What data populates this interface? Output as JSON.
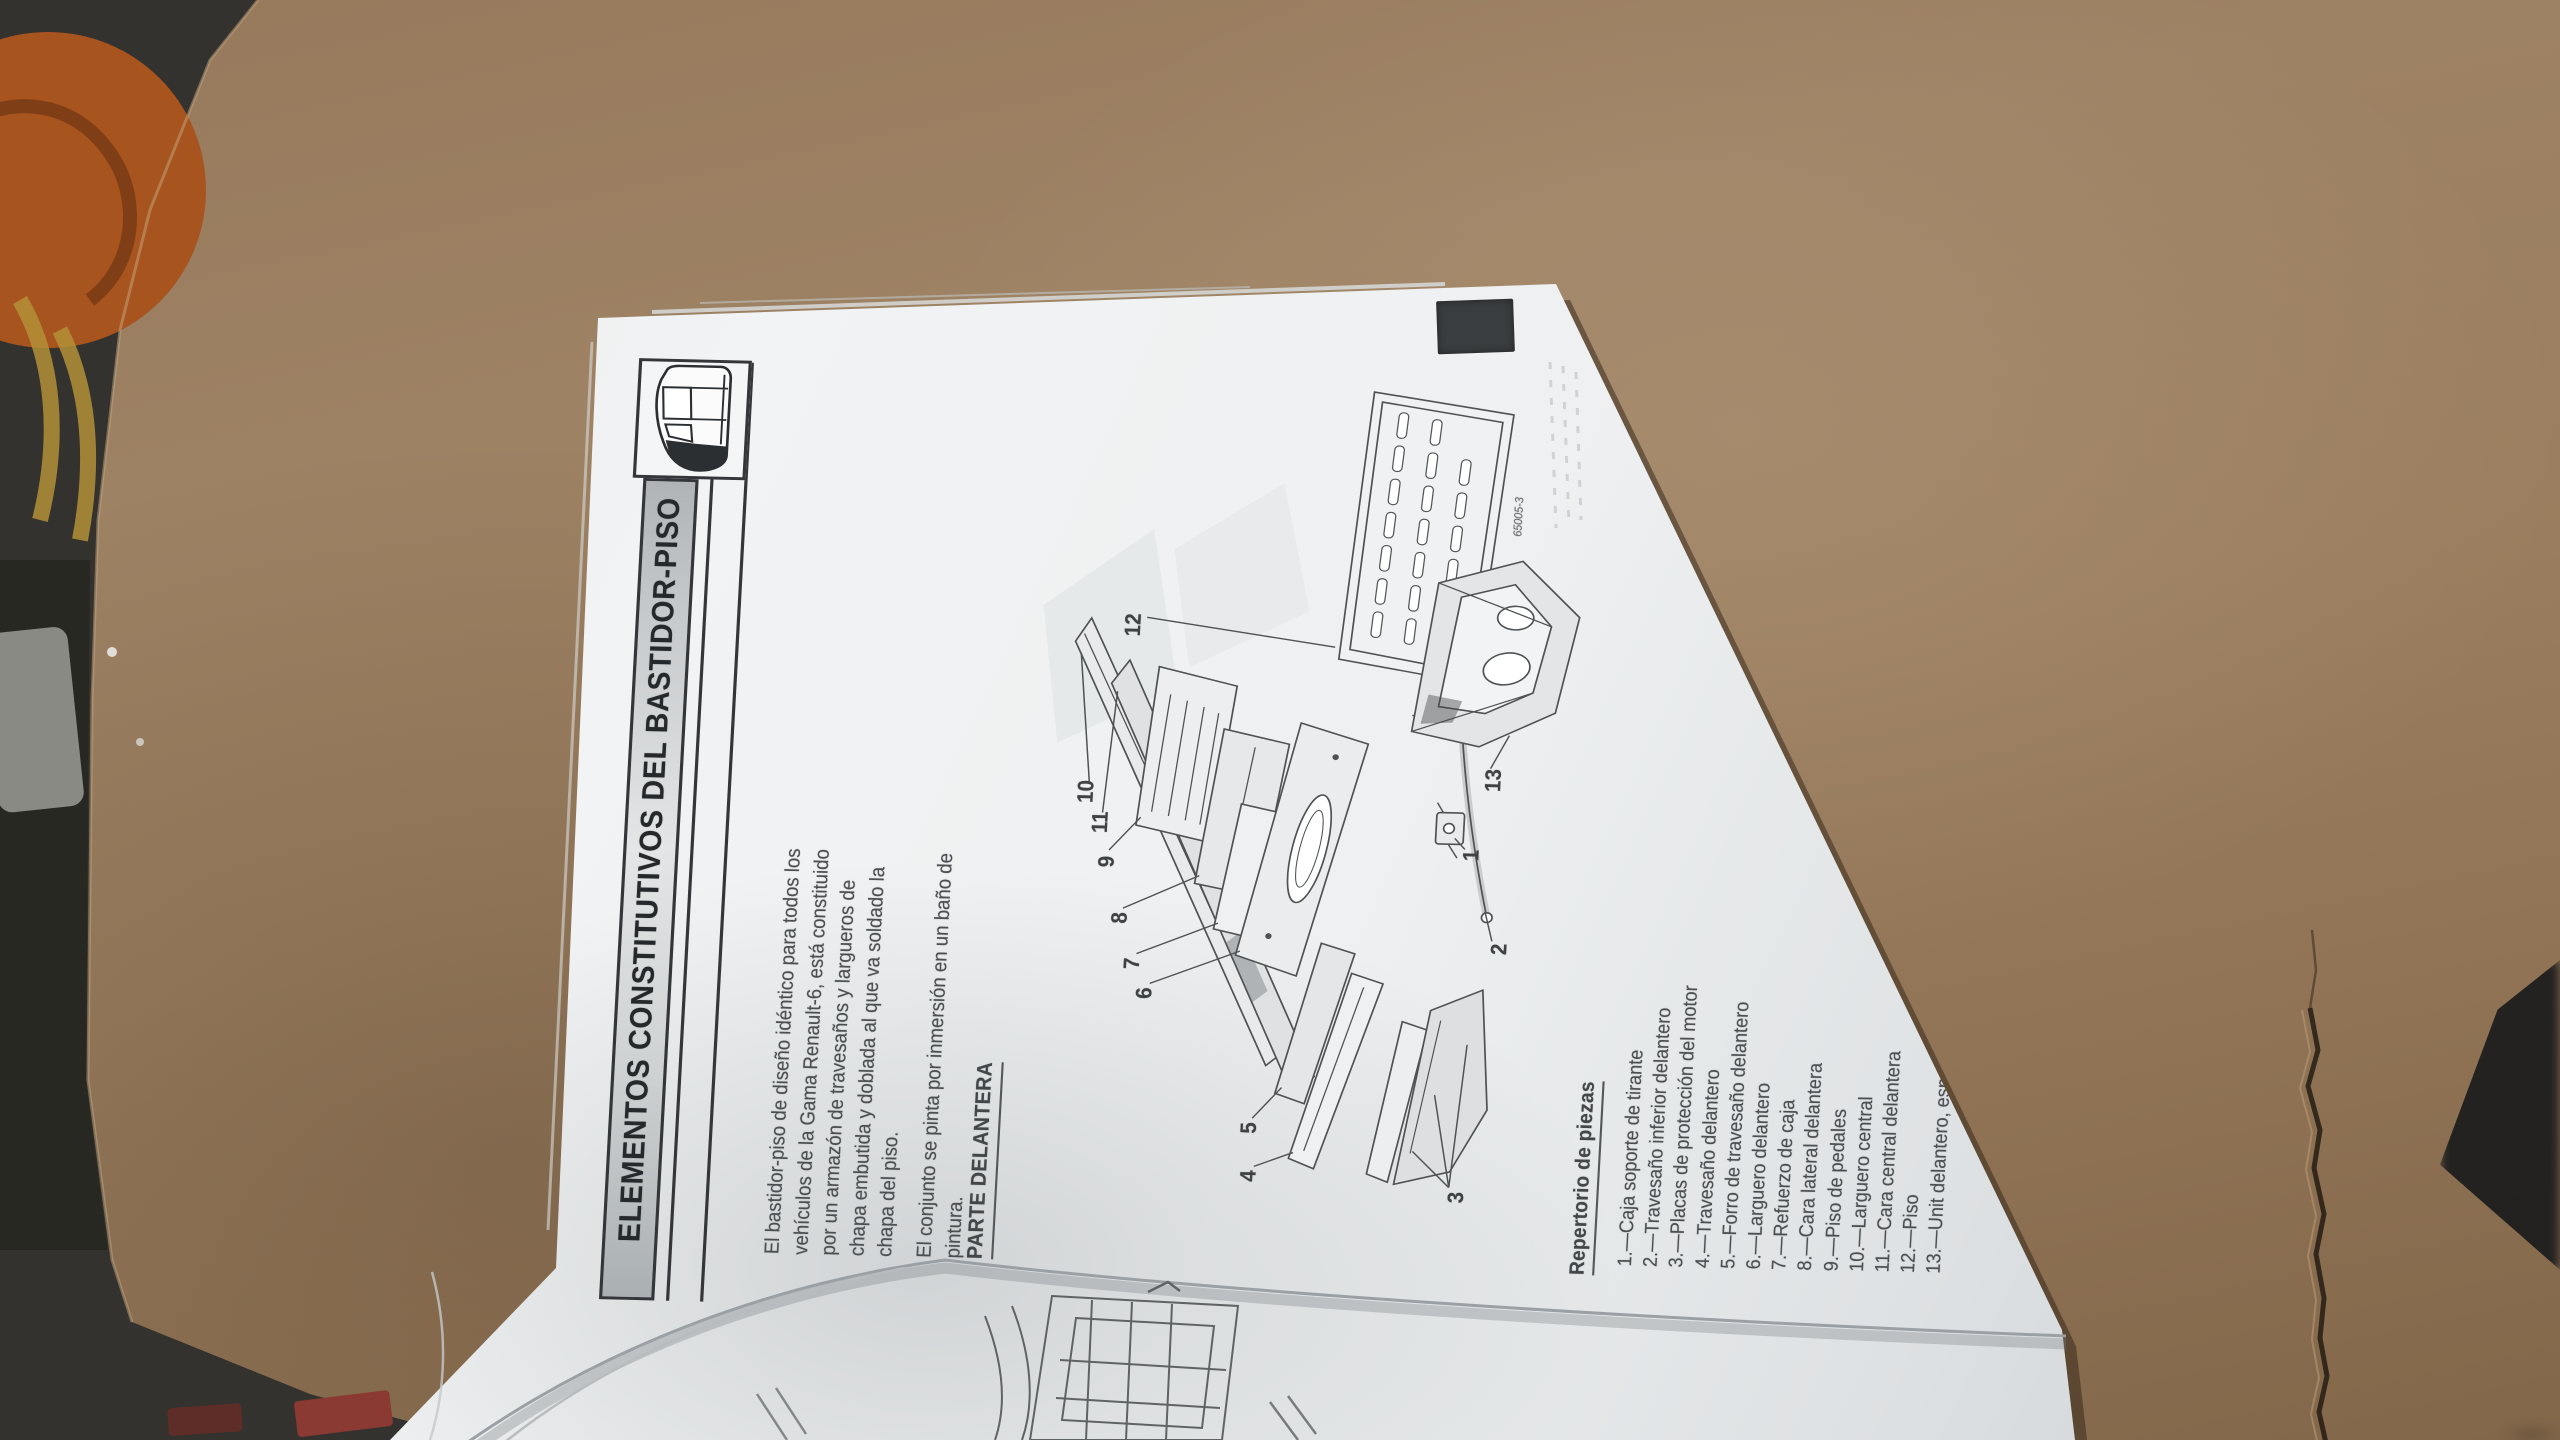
{
  "photo": {
    "palette": {
      "cardboard": "#9b7f61",
      "paper": "#eceef0",
      "ink": "#45494c",
      "banner_fill": "#cfd2d3",
      "index_tab": "#3a3d3f",
      "floor": "#34322e",
      "tool_orange": "#a8541f",
      "tool_yellow": "#b49038",
      "tool_red": "#8a3a32"
    }
  },
  "page": {
    "banner": {
      "title": "ELEMENTOS CONSTITUTIVOS DEL BASTIDOR-PISO",
      "icon": "car-side-icon"
    },
    "intro": {
      "p1": [
        "El bastidor-piso de diseño idéntico para todos los",
        "vehículos de la Gama Renault-6, está constituido",
        "por un armazón de travesaños y largueros de",
        "chapa embutida y doblada al que va soldado la",
        "chapa del piso."
      ],
      "p2": [
        "El conjunto se pinta por inmersión en un baño de",
        "pintura."
      ]
    },
    "section_heading": "PARTE DELANTERA",
    "figure": {
      "code": "65005-3",
      "callouts": [
        "1",
        "2",
        "3",
        "4",
        "5",
        "6",
        "7",
        "8",
        "9",
        "10",
        "11",
        "12",
        "13"
      ]
    },
    "parts": {
      "heading": "Repertorio de piezas",
      "separator": ".—",
      "items": [
        {
          "num": "1",
          "label": "Caja soporte de tirante"
        },
        {
          "num": "2",
          "label": "Travesaño inferior delantero"
        },
        {
          "num": "3",
          "label": "Placas de protección del motor"
        },
        {
          "num": "4",
          "label": "Travesaño delantero"
        },
        {
          "num": "5",
          "label": "Forro de travesaño delantero"
        },
        {
          "num": "6",
          "label": "Larguero delantero"
        },
        {
          "num": "7",
          "label": "Refuerzo de caja"
        },
        {
          "num": "8",
          "label": "Cara lateral delantera"
        },
        {
          "num": "9",
          "label": "Piso de pedales"
        },
        {
          "num": "10",
          "label": "Larguero central"
        },
        {
          "num": "11",
          "label": "Cara central delantera"
        },
        {
          "num": "12",
          "label": "Piso"
        },
        {
          "num": "13",
          "label": "Unit delantero, especial reparación"
        }
      ]
    },
    "page_number": "M-25"
  }
}
